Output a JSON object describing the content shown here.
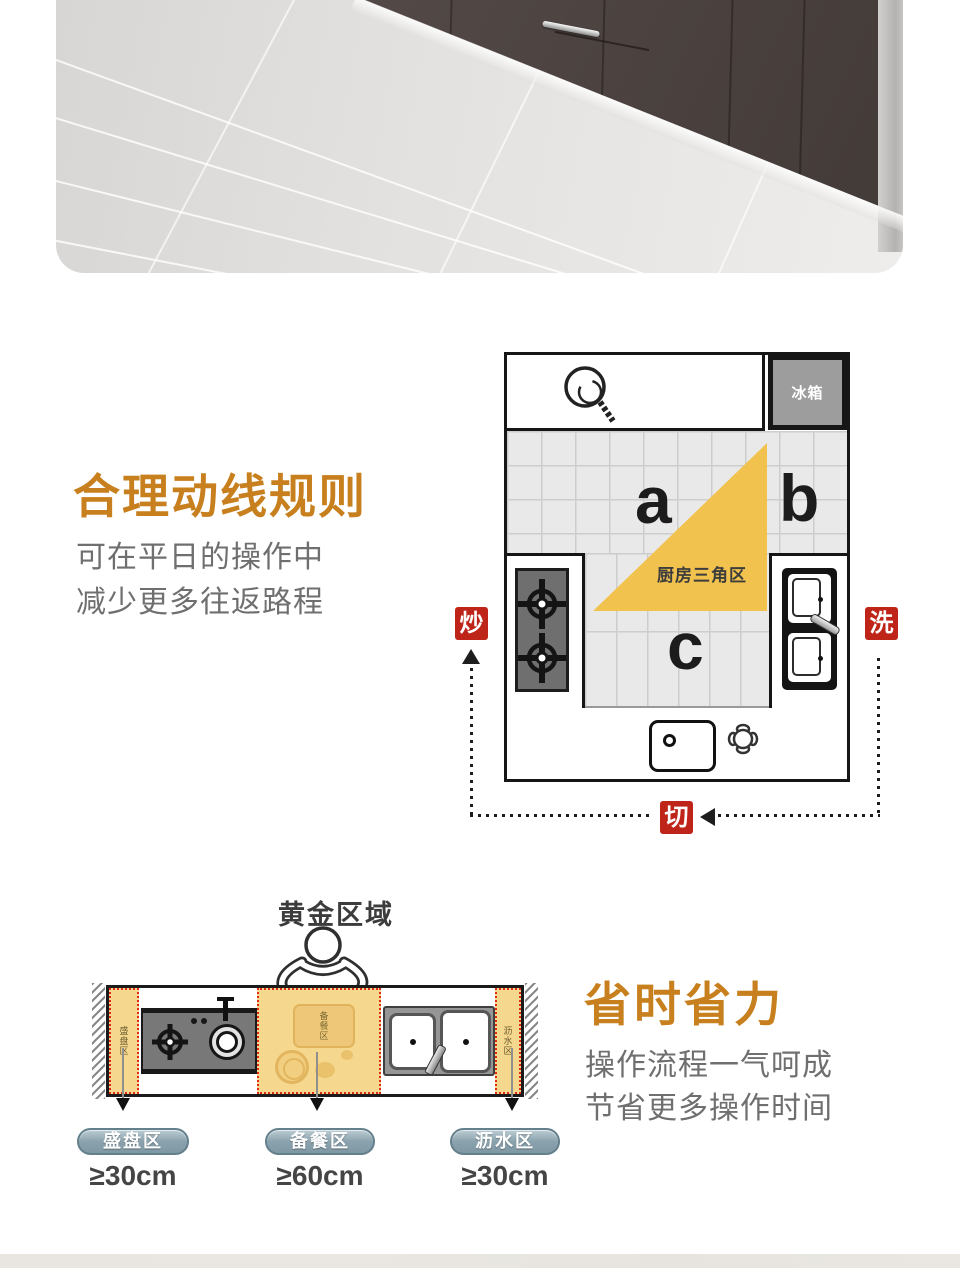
{
  "hero": {
    "floor_color": "#e3e1df",
    "cabinet_color": "#4f4643"
  },
  "flow_section": {
    "title": "合理动线规则",
    "line1": "可在平日的操作中",
    "line2": "减少更多往返路程",
    "plan": {
      "fridge": "冰箱",
      "triangle": "厨房三角区",
      "a": "a",
      "b": "b",
      "c": "c",
      "stirfry": "炒",
      "wash": "洗",
      "cut": "切"
    }
  },
  "zones_section": {
    "title": "省时省力",
    "line1": "操作流程一气呵成",
    "line2": "节省更多操作时间",
    "golden": "黄金区域",
    "zones": [
      {
        "name": "盛盘区",
        "measure": "≥30cm"
      },
      {
        "name": "备餐区",
        "measure": "≥60cm"
      },
      {
        "name": "沥水区",
        "measure": "≥30cm"
      }
    ]
  },
  "colors": {
    "accent": "#C8801E",
    "badge_red": "#BE2418",
    "gold": "#F2C24E",
    "zone_yellow": "#F5D88D",
    "pill": "#8BA3AF",
    "text_gray": "#6F6F6F"
  }
}
